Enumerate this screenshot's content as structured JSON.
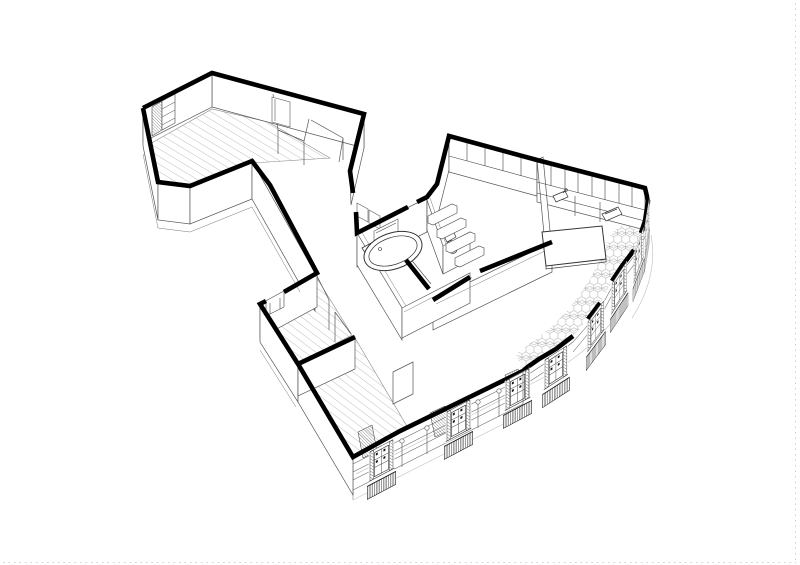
{
  "page": {
    "background": "#ffffff",
    "border_color": "#d8d8d8",
    "border_style": "dotted-right-and-bottom"
  },
  "drawing": {
    "type": "axonometric-cutaway-floor-plan",
    "ink_color": "#000000",
    "cut_wall_color": "#000000",
    "thin_line_color": "#444444",
    "faint_line_color": "#bbbbbb",
    "hatch_line_color": "#8a8a8a",
    "tile_line_color": "#aaaaaa",
    "floor_fill": "#ffffff",
    "elements": {
      "rooms": [
        "bedroom-northwest",
        "back-closet",
        "entry-hall",
        "corridor",
        "bathroom",
        "wc",
        "utility-closet",
        "kitchen-dining",
        "living-room",
        "bedroom-south-upper",
        "bedroom-south-lower"
      ],
      "fixtures": [
        "bathtub",
        "washbasin",
        "mirror",
        "toilet",
        "shelving",
        "kitchen-cabinets",
        "kitchen-sink",
        "cooktop",
        "dining-table",
        "wardrobe",
        "radiator"
      ],
      "floor_finishes": [
        "wood-planks",
        "hexagonal-tiles"
      ],
      "facade_features": [
        "french-windows",
        "balcony-railings",
        "shutter-jambs",
        "pilasters"
      ]
    }
  }
}
